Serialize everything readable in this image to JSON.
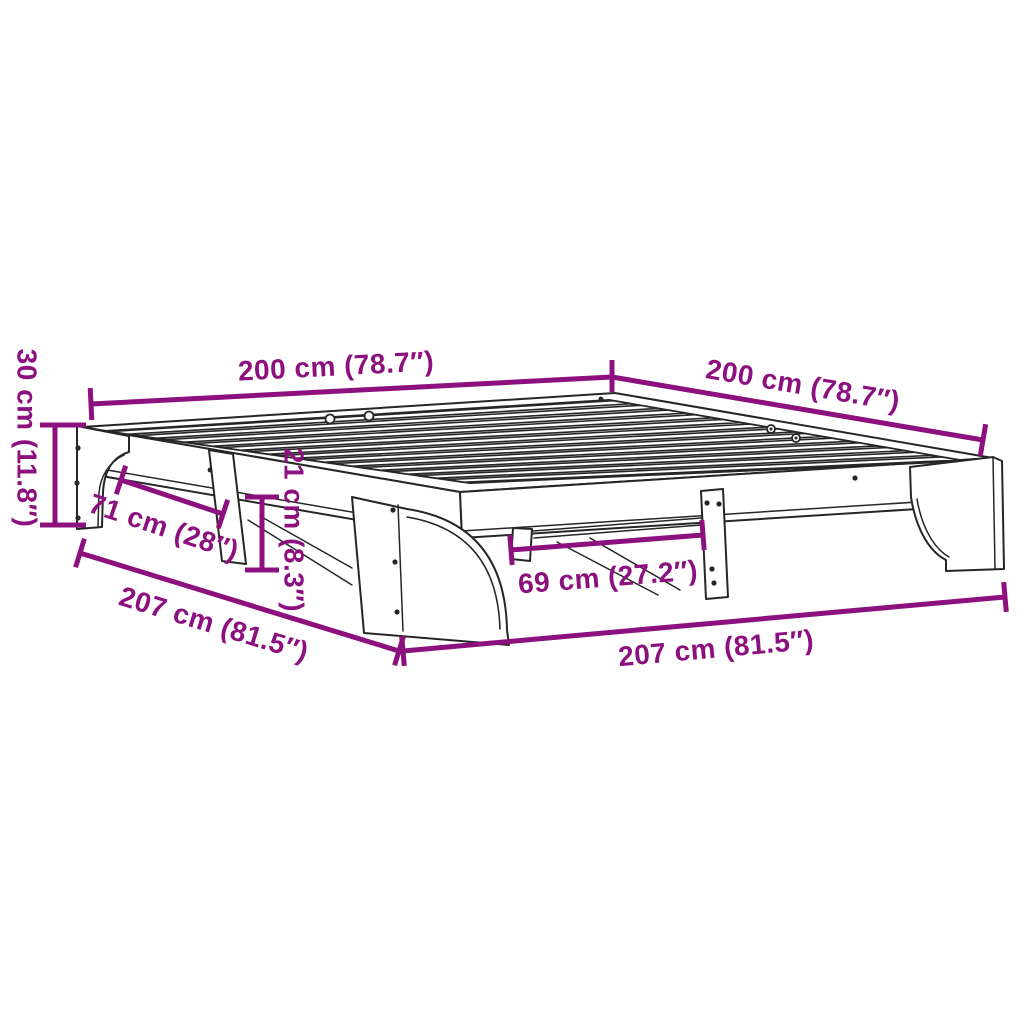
{
  "figure": {
    "background_color": "#ffffff",
    "outline_color": "#262626",
    "dimension_color": "#8d107f",
    "slat_count": 13
  },
  "dimensions": [
    {
      "id": "width-back-left",
      "label": "200 cm (78.7″)"
    },
    {
      "id": "width-back-right",
      "label": "200 cm (78.7″)"
    },
    {
      "id": "height-left",
      "label": "30 cm (11.8″)"
    },
    {
      "id": "leg-gap-side",
      "label": "71 cm (28″)"
    },
    {
      "id": "underbed-clearance",
      "label": "21 cm (8.3″)"
    },
    {
      "id": "leg-gap-front",
      "label": "69 cm (27.2″)"
    },
    {
      "id": "length-side",
      "label": "207 cm (81.5″)"
    },
    {
      "id": "length-front",
      "label": "207 cm (81.5″)"
    }
  ]
}
